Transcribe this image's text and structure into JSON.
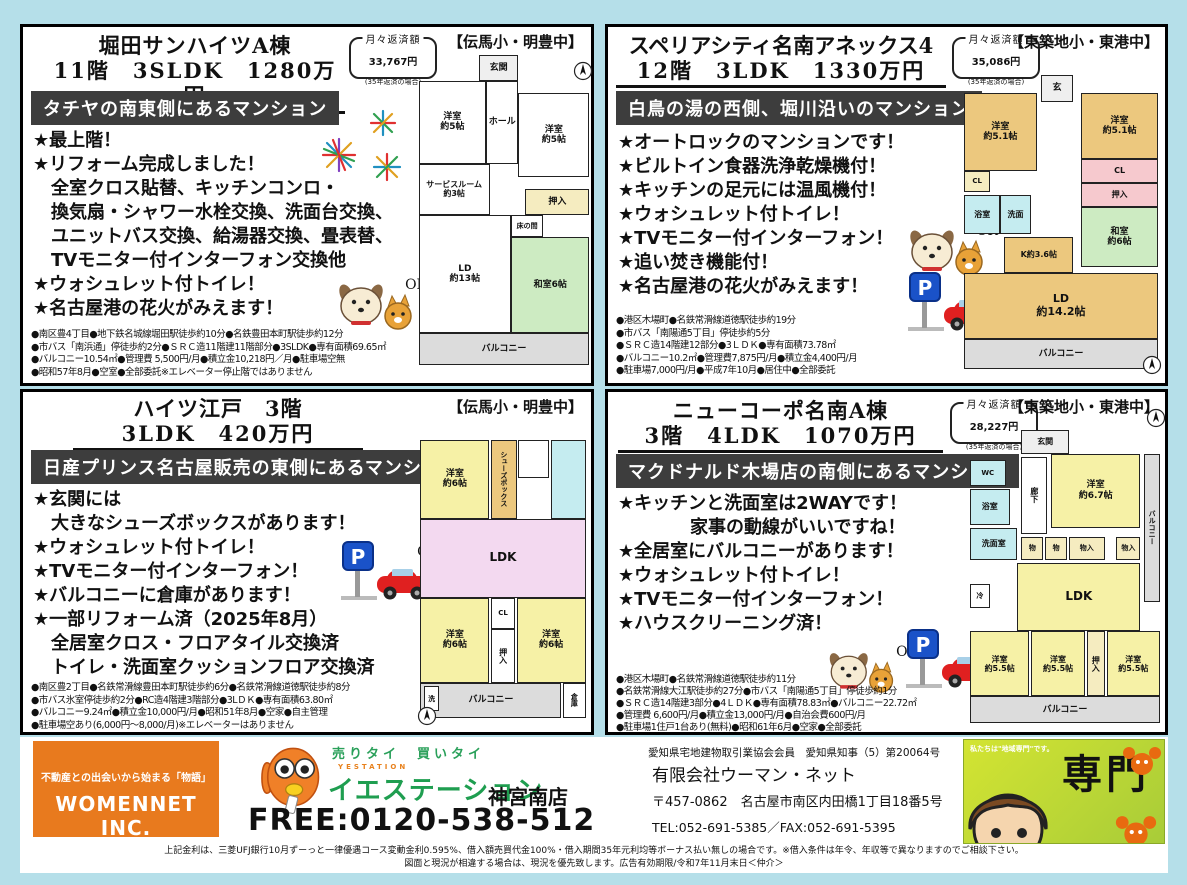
{
  "page": {
    "bg_color": "#b5dfe9",
    "banner_bg": "#3d3d3d",
    "disclaimer1": "上記金利は、三菱UFJ銀行10月ずーっと一律優遇コース変動金利0.595%、借入額売買代金100%・借入期間35年元利均等ボーナス払い無しの場合です。※借入条件は年令、年収等で異なりますのでご相談下さい。",
    "disclaimer2": "図面と現況が相違する場合は、現況を優先致します。広告有効期限/令和7年11月末日＜仲介＞"
  },
  "icons": {
    "ok_label": "OK"
  },
  "listings": [
    {
      "title1": "堀田サンハイツA棟",
      "title2": "11階　3SLDK　1280万円",
      "payment_label": "月々返済額",
      "payment_value": "33,767円",
      "payment_note": "(35年返済の場合)",
      "school": "【伝馬小・明豊中】",
      "banner": "タチヤの南東側にあるマンション",
      "bullets": [
        "★最上階！",
        "★リフォーム完成しました！",
        "　全室クロス貼替、キッチンコンロ・",
        "　換気扇・シャワー水栓交換、洗面台交換、",
        "　ユニットバス交換、給湯器交換、畳表替、",
        "　TVモニター付インターフォン交換他",
        "★ウォシュレット付トイレ！",
        "★名古屋港の花火がみえます！"
      ],
      "details": [
        "●南区豊4丁目●地下鉄名城線堀田駅徒歩約10分●名鉄豊田本町駅徒歩約12分",
        "●市バス「南浜通」停徒歩約2分●ＳＲＣ造11階建11階部分●3SLDK●専有面積69.65㎡",
        "●バルコニー10.54㎡●管理費 5,500円/月●積立金10,218円／月●駐車場空無",
        "●昭和57年8月●空室●全部委託※エレベーター停止階ではありません"
      ],
      "plan_rooms": [
        "玄関",
        "洋室\n約5帖",
        "ホール",
        "洋室\n約5帖",
        "サービスルーム\n約3帖",
        "押入",
        "LD\n約13帖",
        "床の間",
        "和室6帖",
        "バルコニー"
      ]
    },
    {
      "title1": "スペリアシティ名南アネックス4",
      "title2": "12階　3LDK　1330万円",
      "payment_label": "月々返済額",
      "payment_value": "35,086円",
      "payment_note": "(35年返済の場合)",
      "school": "【東築地小・東港中】",
      "banner": "白鳥の湯の西側、堀川沿いのマンション",
      "bullets": [
        "★オートロックのマンションです！",
        "★ビルトイン食器洗浄乾燥機付！",
        "★キッチンの足元には温風機付！",
        "★ウォシュレット付トイレ！",
        "★TVモニター付インターフォン！",
        "★追い焚き機能付！",
        "★名古屋港の花火がみえます！"
      ],
      "details": [
        "●港区木場町●名鉄常滑線道徳駅徒歩約19分",
        "●市バス「南陽通5丁目」停徒歩約5分",
        "●ＳＲＣ造14階建12部分●3ＬＤＫ●専有面積73.78㎡",
        "●バルコニー10.2㎡●管理費7,875円/月●積立金4,400円/月",
        "●駐車場7,000円/月●平成7年10月●居住中●全部委託"
      ],
      "plan_rooms": [
        "玄",
        "洋室\n約5.1帖",
        "洋室\n約5.1帖",
        "CL",
        "浴室",
        "洗面",
        "CL",
        "押入",
        "K約3.6帖",
        "和室\n約6帖",
        "LD\n約14.2帖",
        "バルコニー"
      ]
    },
    {
      "title1": "ハイツ江戸　3階",
      "title2": "3LDK　420万円",
      "school": "【伝馬小・明豊中】",
      "banner": "日産プリンス名古屋販売の東側にあるマンション",
      "bullets": [
        "★玄関には",
        "　大きなシューズボックスがあります！",
        "★ウォシュレット付トイレ！",
        "★TVモニター付インターフォン！",
        "★バルコニーに倉庫があります！",
        "★一部リフォーム済（2025年8月）",
        "　全居室クロス・フロアタイル交換済",
        "　トイレ・洗面室クッションフロア交換済"
      ],
      "details": [
        "●南区豊2丁目●名鉄常滑線豊田本町駅徒歩約6分●名鉄常滑線道徳駅徒歩約8分",
        "●市バス氷室停徒歩約2分●RC造4階建3階部分●3LＤＫ●専有面積63.80㎡",
        "●バルコニー9.24㎡●積立金10,000円/月●昭和51年8月●空家●自主管理",
        "●駐車場空あり(6,000円〜8,000/月)※エレベーターはありません"
      ],
      "plan_rooms": [
        "洋室\n約6帖",
        "シューズボックス",
        "LDK",
        "洋室\n約6帖",
        "CL",
        "押入",
        "洋室\n約6帖",
        "洗",
        "バルコニー",
        "倉庫"
      ]
    },
    {
      "title1": "ニューコーポ名南A棟",
      "title2": "3階　4LDK　1070万円",
      "payment_label": "月々返済額",
      "payment_value": "28,227円",
      "payment_note": "(35年返済の場合)",
      "school": "【東築地小・東港中】",
      "banner": "マクドナルド木場店の南側にあるマンション",
      "bullets": [
        "★キッチンと洗面室は2WAYです！",
        "　　　　家事の動線がいいですね！",
        "★全居室にバルコニーがあります！",
        "★ウォシュレット付トイレ！",
        "★TVモニター付インターフォン！",
        "★ハウスクリーニング済！"
      ],
      "details": [
        "●港区木場町●名鉄常滑線道徳駅徒歩約11分",
        "●名鉄常滑線大江駅徒歩約27分●市バス「南陽通5丁目」停徒歩約1分",
        "●ＳＲＣ造14階建3部分●4ＬＤＫ●専有面積78.83㎡●バルコニー22.72㎡",
        "●管理費 6,600円/月●積立金13,000円/月●自治会費600円/月",
        "●駐車場1住戸1台あり(無料)●昭和61年6月●空家●全部委託"
      ],
      "plan_rooms": [
        "玄関",
        "WC",
        "浴室",
        "洗面室",
        "廊下",
        "洋室\n約6.7帖",
        "物",
        "物",
        "物入",
        "LDK",
        "冷",
        "物入",
        "洋室\n約5.5帖",
        "洋室\n約5.5帖",
        "押入",
        "洋室\n約5.5帖",
        "バルコニー",
        "バルコニー"
      ]
    }
  ],
  "footer": {
    "womennet_tagline": "不動産との出会いから始まる「物語」",
    "womennet_name": "WOMENNET INC.",
    "catch": "売りタイ　買いタイ",
    "brand_en": "YESTATION",
    "brand": "イエステーション",
    "branch": "神宮南店",
    "phone": "FREE:0120-538-512",
    "assoc": "愛知県宅地建物取引業協会会員　愛知県知事（5）第20064号",
    "company": "有限会社ウーマン・ネット",
    "address": "〒457-0862　名古屋市南区内田橋1丁目18番5号",
    "tel": "TEL:052-691-5385／FAX:052-691-5395",
    "senmon_small": "私たちは\"地域専門\"です。",
    "senmon_big": "専門"
  }
}
